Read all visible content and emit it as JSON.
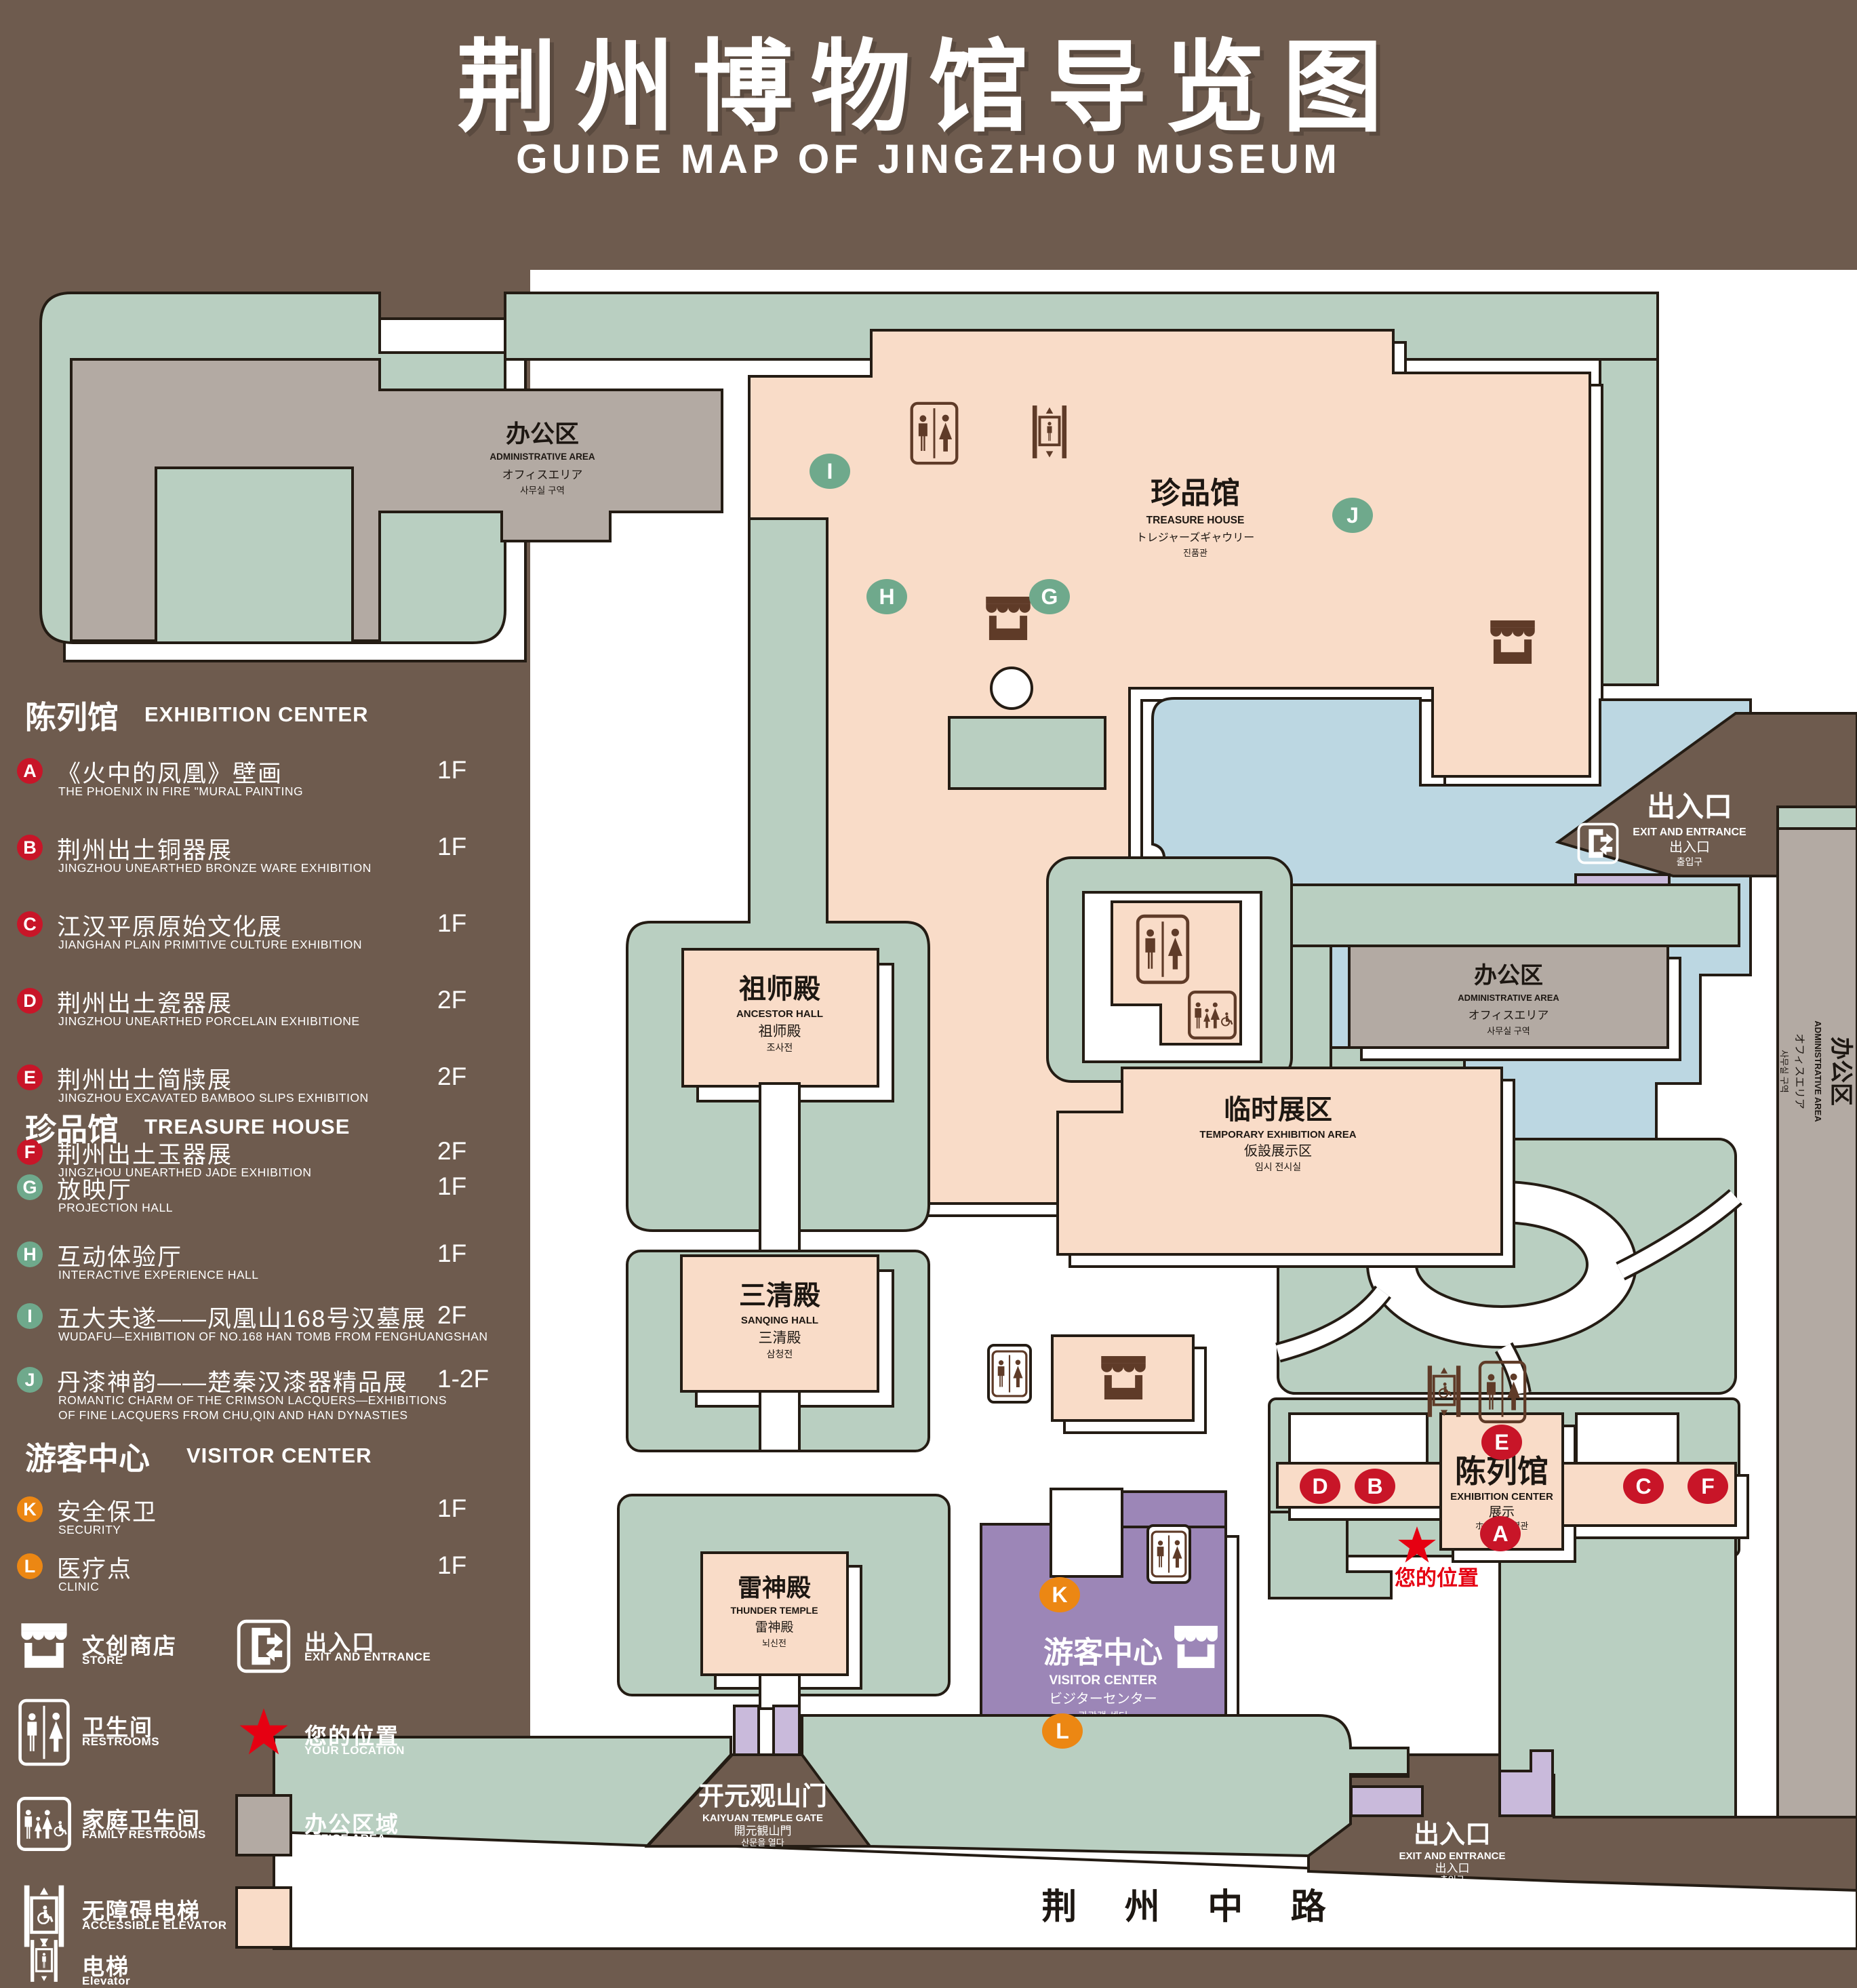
{
  "title": {
    "zh": "荆州博物馆导览图",
    "en": "GUIDE MAP OF JINGZHOU MUSEUM"
  },
  "colors": {
    "background": "#6e5b4e",
    "map_bg": "#ffffff",
    "green_area": "#b9cfc1",
    "display_area": "#f9dcc8",
    "office_area": "#b3aaa3",
    "water": "#bcd7e2",
    "visitor_center": "#9c86b7",
    "gate_purple": "#c9badb",
    "marker_red": "#c81528",
    "marker_green": "#6fa98c",
    "marker_orange": "#ec8713",
    "icon_brown": "#5f3b28",
    "location_red": "#e60012"
  },
  "legend": {
    "sections": [
      {
        "zh": "陈列馆",
        "en": "EXHIBITION CENTER",
        "marker_color": "#c81528",
        "items": [
          {
            "key": "A",
            "zh": "《火中的凤凰》壁画",
            "en": "THE PHOENIX IN FIRE \"MURAL PAINTING",
            "floor": "1F"
          },
          {
            "key": "B",
            "zh": "荆州出土铜器展",
            "en": "JINGZHOU UNEARTHED BRONZE WARE EXHIBITION",
            "floor": "1F"
          },
          {
            "key": "C",
            "zh": "江汉平原原始文化展",
            "en": "JIANGHAN PLAIN PRIMITIVE CULTURE EXHIBITION",
            "floor": "1F"
          },
          {
            "key": "D",
            "zh": "荆州出土瓷器展",
            "en": "JINGZHOU UNEARTHED PORCELAIN EXHIBITIONE",
            "floor": "2F"
          },
          {
            "key": "E",
            "zh": "荆州出土简牍展",
            "en": "JINGZHOU EXCAVATED BAMBOO SLIPS EXHIBITION",
            "floor": "2F"
          },
          {
            "key": "F",
            "zh": "荆州出土玉器展",
            "en": "JINGZHOU UNEARTHED JADE EXHIBITION",
            "floor": "2F"
          }
        ]
      },
      {
        "zh": "珍品馆",
        "en": "TREASURE HOUSE",
        "marker_color": "#6fa98c",
        "items": [
          {
            "key": "G",
            "zh": "放映厅",
            "en": "PROJECTION HALL",
            "floor": "1F"
          },
          {
            "key": "H",
            "zh": "互动体验厅",
            "en": "INTERACTIVE EXPERIENCE HALL",
            "floor": "1F"
          },
          {
            "key": "I",
            "zh": "五大夫遂——凤凰山168号汉墓展",
            "en": "WUDAFU—EXHIBITION OF NO.168 HAN TOMB FROM FENGHUANGSHAN",
            "floor": "2F"
          },
          {
            "key": "J",
            "zh": "丹漆神韵——楚秦汉漆器精品展",
            "en": "ROMANTIC CHARM OF THE CRIMSON LACQUERS—EXHIBITIONS",
            "en2": "OF FINE LACQUERS FROM CHU,QIN AND HAN DYNASTIES",
            "floor": "1-2F"
          }
        ]
      },
      {
        "zh": "游客中心",
        "en": "VISITOR CENTER",
        "marker_color": "#ec8713",
        "items": [
          {
            "key": "K",
            "zh": "安全保卫",
            "en": "SECURITY",
            "floor": "1F"
          },
          {
            "key": "L",
            "zh": "医疗点",
            "en": "CLINIC",
            "floor": "1F"
          }
        ]
      }
    ],
    "symbols_left": [
      {
        "icon": "store",
        "zh": "文创商店",
        "en": "STORE"
      },
      {
        "icon": "restroom",
        "zh": "卫生间",
        "en": "RESTROOMS"
      },
      {
        "icon": "family-restroom",
        "zh": "家庭卫生间",
        "en": "FAMILY RESTROOMS"
      },
      {
        "icon": "accessible-elevator",
        "zh": "无障碍电梯",
        "en": "ACCESSIBLE  ELEVATOR"
      },
      {
        "icon": "elevator",
        "zh": "电梯",
        "en": "Elevator"
      }
    ],
    "symbols_right": [
      {
        "icon": "exit",
        "zh": "出入口",
        "en": "EXIT AND ENTRANCE"
      },
      {
        "icon": "star",
        "zh": "您的位置",
        "en": "YOUR LOCATION"
      },
      {
        "icon": "office-swatch",
        "zh": "办公区域",
        "en": "OFFICE AREA"
      },
      {
        "icon": "display-swatch",
        "zh": "展示区域",
        "en": "DISPLAY AREA"
      }
    ]
  },
  "map": {
    "admin": {
      "zh": "办公区",
      "en": "ADMINISTRATIVE AREA",
      "ja": "オフィスエリア",
      "ko": "사무실 구역"
    },
    "treasure_house": {
      "zh": "珍品馆",
      "en": "TREASURE HOUSE",
      "ja": "トレジャーズギャウリー",
      "ko": "진품관"
    },
    "ancestor_hall": {
      "zh": "祖师殿",
      "en": "ANCESTOR HALL",
      "ja": "祖师殿",
      "ko": "조사전"
    },
    "sanqing_hall": {
      "zh": "三清殿",
      "en": "SANQING HALL",
      "ja": "三清殿",
      "ko": "삼청전"
    },
    "thunder_temple": {
      "zh": "雷神殿",
      "en": "THUNDER TEMPLE",
      "ja": "雷神殿",
      "ko": "뇌신전"
    },
    "temporary_exhibition": {
      "zh": "临时展区",
      "en": "TEMPORARY EXHIBITION AREA",
      "ja": "仮設展示区",
      "ko": "임시 전시실"
    },
    "visitor_center": {
      "zh": "游客中心",
      "en": "VISITOR CENTER",
      "ja": "ビジターセンター",
      "ko": "관광객 센터"
    },
    "exhibition_center": {
      "zh": "陈列馆",
      "en": "EXHIBITION CENTER",
      "ja": "展示",
      "line2": "ホール 진열관"
    },
    "kaiyuan_gate": {
      "zh": "开元观山门",
      "en": "KAIYUAN TEMPLE GATE",
      "ja": "開元観山門",
      "ko": "산문을 열다"
    },
    "exit": {
      "zh": "出入口",
      "en": "EXIT AND ENTRANCE",
      "ja": "出入口",
      "ko": "출입구"
    },
    "road": "荆 州 中 路",
    "your_location": "您的位置",
    "markers": {
      "A": "A",
      "B": "B",
      "C": "C",
      "D": "D",
      "E": "E",
      "F": "F",
      "G": "G",
      "H": "H",
      "I": "I",
      "J": "J",
      "K": "K",
      "L": "L"
    }
  }
}
